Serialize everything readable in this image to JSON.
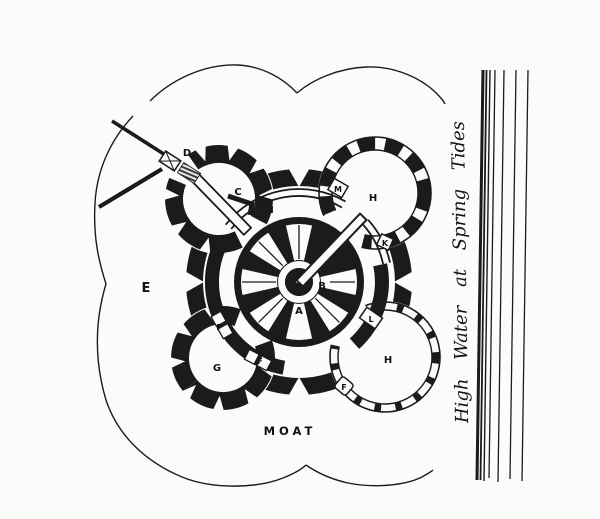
{
  "figure": {
    "type": "engraved castle plan with moat and shoreline",
    "plan_letters": {
      "a": "A",
      "b": "B",
      "c": "C",
      "d": "D",
      "e": "E",
      "f": "F",
      "g": "G",
      "h": "H",
      "i": "I",
      "k": "K",
      "l": "L",
      "m": "M"
    },
    "moat_label": "MOAT",
    "shore_caption": "High Water at Spring Tides",
    "ink_color": "#1b1b1b",
    "paper_color": "#fbfbf9"
  }
}
